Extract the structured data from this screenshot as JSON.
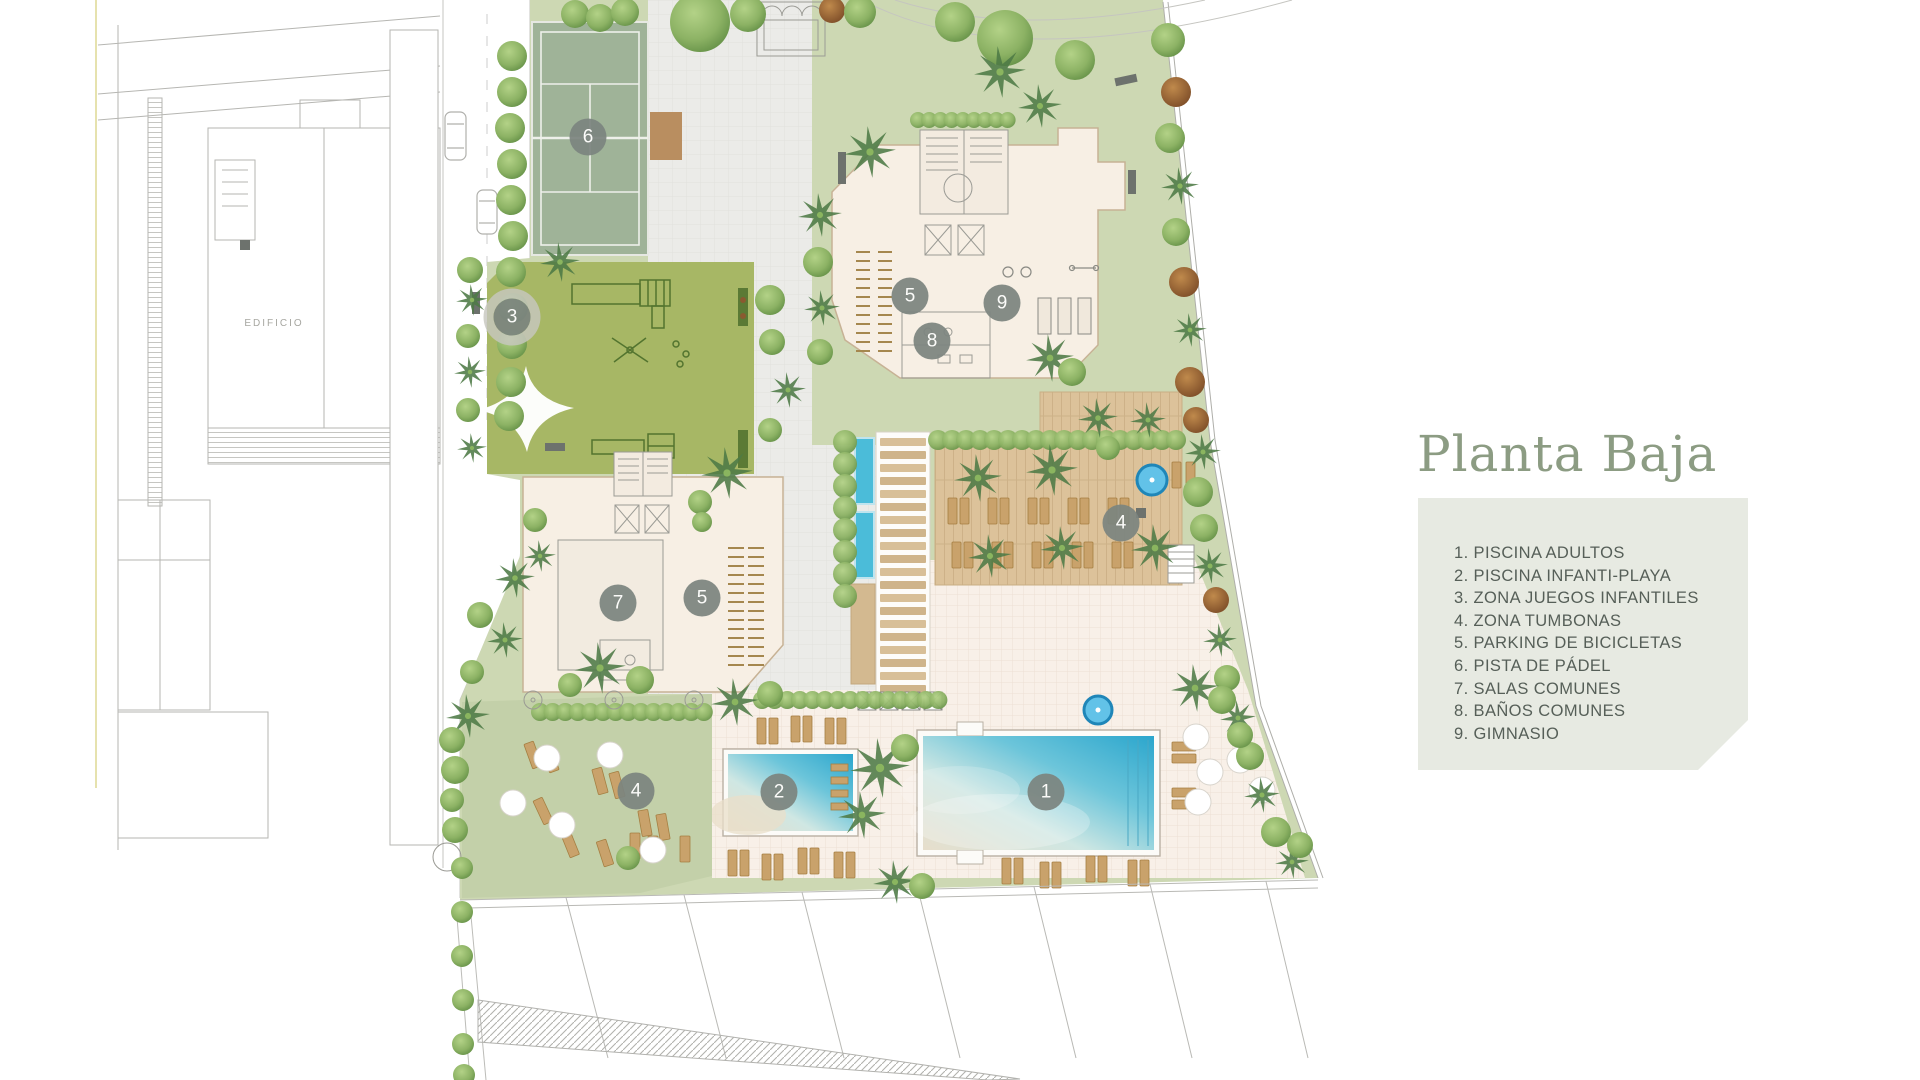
{
  "title": "Planta Baja",
  "neighbor_building_label": "EDIFICIO",
  "legend": {
    "items": [
      {
        "num": "1",
        "label": "PISCINA ADULTOS"
      },
      {
        "num": "2",
        "label": "PISCINA INFANTI-PLAYA"
      },
      {
        "num": "3",
        "label": "ZONA JUEGOS INFANTILES"
      },
      {
        "num": "4",
        "label": "ZONA TUMBONAS"
      },
      {
        "num": "5",
        "label": "PARKING DE BICICLETAS"
      },
      {
        "num": "6",
        "label": "PISTA DE PÁDEL"
      },
      {
        "num": "7",
        "label": "SALAS COMUNES"
      },
      {
        "num": "8",
        "label": "BAÑOS COMUNES"
      },
      {
        "num": "9",
        "label": "GIMNASIO"
      }
    ]
  },
  "map_markers": [
    {
      "num": "6",
      "x": 588,
      "y": 137,
      "variant": "plain"
    },
    {
      "num": "3",
      "x": 512,
      "y": 317,
      "variant": "ring"
    },
    {
      "num": "5",
      "x": 910,
      "y": 296,
      "variant": "plain"
    },
    {
      "num": "9",
      "x": 1002,
      "y": 303,
      "variant": "plain"
    },
    {
      "num": "8",
      "x": 932,
      "y": 341,
      "variant": "plain"
    },
    {
      "num": "7",
      "x": 618,
      "y": 603,
      "variant": "plain"
    },
    {
      "num": "5",
      "x": 702,
      "y": 598,
      "variant": "plain"
    },
    {
      "num": "4",
      "x": 1121,
      "y": 523,
      "variant": "plain"
    },
    {
      "num": "4",
      "x": 636,
      "y": 791,
      "variant": "plain"
    },
    {
      "num": "2",
      "x": 779,
      "y": 792,
      "variant": "plain"
    },
    {
      "num": "1",
      "x": 1046,
      "y": 792,
      "variant": "plain"
    }
  ],
  "colors": {
    "title_green": "#8c9c83",
    "legend_bg": "#e7eae2",
    "legend_text": "#565f58",
    "marker_bg": "#7c847f",
    "lawn": "#cdd8b3",
    "playground_green": "#a7b765",
    "padel_green": "#9fb398",
    "building_cream": "#f7efe4",
    "deck_wood": "#dcc29a",
    "pool_turquoise": "#2ba6cd",
    "paving_gray": "#ebebe8",
    "paving_cream": "#f8f0e8"
  }
}
